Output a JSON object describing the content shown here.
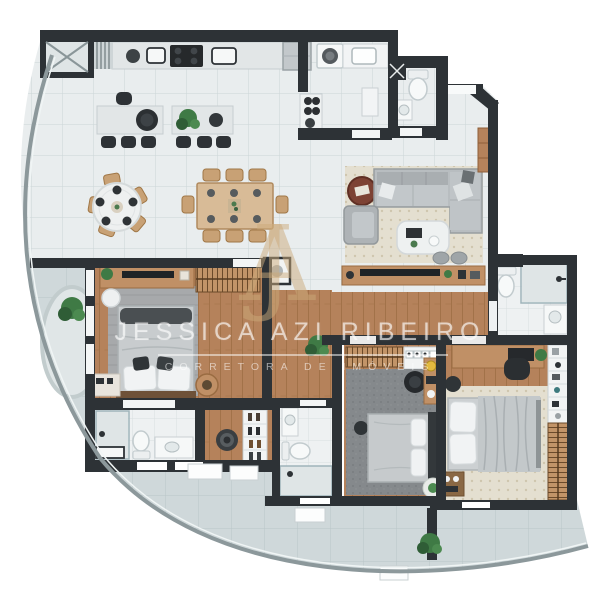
{
  "watermark": {
    "monogram": "JA",
    "name": "JESSICA AZI RIBEIRO",
    "subtitle": "CORRETORA DE IMÓVEIS"
  },
  "palette": {
    "wall": "#2d3236",
    "tile_floor": "#e9edee",
    "tile_grid": "#ccd5d7",
    "wood_floor": "#b5825b",
    "balcony_floor": "#cfd8da",
    "rug_beige": "#e4dfd0",
    "rug_gray": "#a7a9ab",
    "rug_dark": "#85898c",
    "sofa_gray": "#b8bdc0",
    "furniture_wood": "#c29468",
    "accent_rust": "#7d4234",
    "plant_green": "#3f7a45",
    "fixture_white": "#f6f8f8",
    "watermark_gold": "#cbaa7a"
  }
}
